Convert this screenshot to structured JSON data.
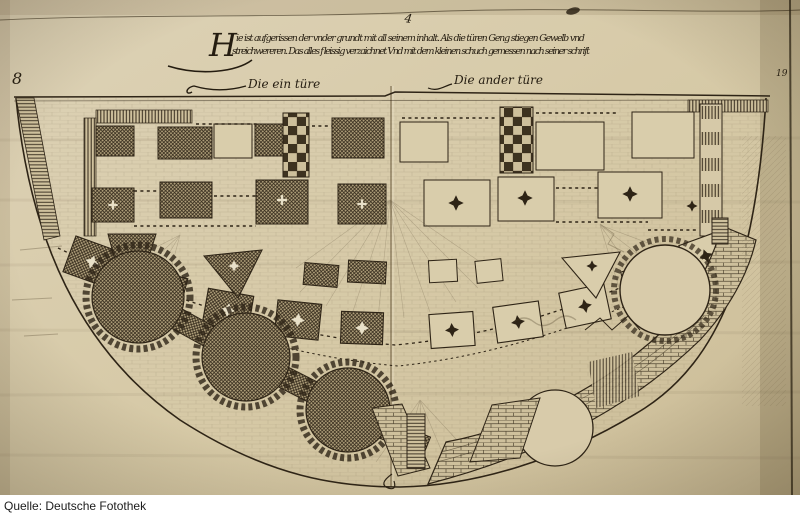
{
  "photo": {
    "paper_color": "#d8cbaa",
    "ink_color": "#2e2416",
    "description": "woodcut ground plan of a semicircular bastion fortification"
  },
  "caption": {
    "initial": "H",
    "line1": "ie ist aufgerissen der vnder grundt mit all seinem inhalt. Als die türen Geng stiegen Gewelb vnd",
    "line2": "streichwereren. Das alles fleissig verzaichnet Vnd mit dem kleinen schuch gemessen nach seiner schrift"
  },
  "labels": {
    "left_door": "Die ein türe",
    "right_door": "Die ander türe"
  },
  "marks": {
    "top_mark": "4",
    "left_folio": "8",
    "right_folio": "19"
  },
  "source_bar": {
    "label": "Quelle: Deutsche Fotothek"
  }
}
